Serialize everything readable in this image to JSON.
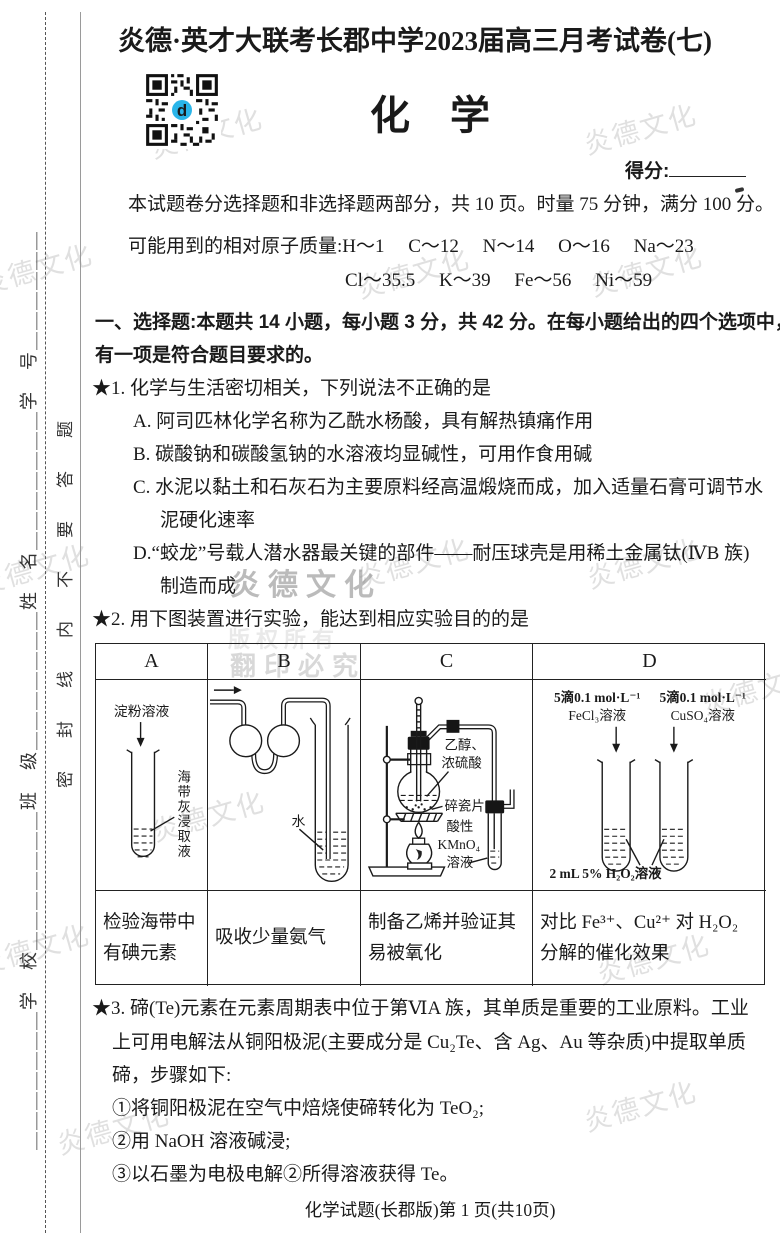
{
  "header": {
    "exam_title": "炎德·英才大联考长郡中学2023届高三月考试卷(七)",
    "subject_title": "化　学",
    "score_label": "得分:"
  },
  "margin": {
    "fields_line": "＿＿＿＿＿＿＿学　校＿＿＿＿＿＿＿班　级＿＿＿＿＿＿＿姓　名＿＿＿＿＿＿＿学　号＿＿＿＿＿＿",
    "seal_notice": "密封线内不要答题"
  },
  "intro": {
    "summary": "本试题卷分选择题和非选择题两部分，共 10 页。时量 75 分钟，满分 100 分。",
    "masses_line1": "可能用到的相对原子质量:H～1　 C～12　 N～14　 O～16　 Na～23",
    "masses_line2": "Cl～35.5　 K～39　 Fe～56　 Ni～59"
  },
  "section_one": {
    "line1": "一、选择题:本题共 14 小题，每小题 3 分，共 42 分。在每小题给出的四个选项中，只",
    "line2": "有一项是符合题目要求的。"
  },
  "q1": {
    "stem": "★1. 化学与生活密切相关，下列说法不正确的是",
    "option_a": "A. 阿司匹林化学名称为乙酰水杨酸，具有解热镇痛作用",
    "option_b": "B. 碳酸钠和碳酸氢钠的水溶液均显碱性，可用作食用碱",
    "option_c1": "C. 水泥以黏土和石灰石为主要原料经高温煅烧而成，加入适量石膏可调节水",
    "option_c2": "泥硬化速率",
    "option_d1": "D.“蛟龙”号载人潜水器最关键的部件——耐压球壳是用稀土金属钛(ⅣB 族)",
    "option_d2": "制造而成"
  },
  "q2": {
    "stem": "★2. 用下图装置进行实验，能达到相应实验目的的是",
    "table": {
      "headers": [
        "A",
        "B",
        "C",
        "D"
      ],
      "captions": {
        "a1": "检验海带中",
        "a2": "有碘元素",
        "b": "吸收少量氨气",
        "c1": "制备乙烯并验证其",
        "c2": "易被氧化",
        "d1": "对比 Fe³⁺、Cu²⁺ 对 H₂O₂",
        "d2": "分解的催化效果"
      }
    },
    "diagrams": {
      "a": {
        "top_label": "淀粉溶液",
        "side_chars": [
          "海",
          "带",
          "灰",
          "浸",
          "取",
          "液"
        ]
      },
      "b": {
        "water": "水"
      },
      "c": {
        "l1a": "乙醇、",
        "l1b": "浓硫酸",
        "l2": "碎瓷片",
        "l3a": "酸性",
        "l3b": "KMnO₄",
        "l3c": "溶液"
      },
      "d": {
        "left1": "5滴0.1 mol·L⁻¹",
        "left2": "FeCl₃溶液",
        "right1": "5滴0.1 mol·L⁻¹",
        "right2": "CuSO₄溶液",
        "bottom": "2 mL 5% H₂O₂溶液"
      }
    }
  },
  "q3": {
    "line1": "★3. 碲(Te)元素在元素周期表中位于第ⅥA 族，其单质是重要的工业原料。工业",
    "line2": "上可用电解法从铜阳极泥(主要成分是 Cu₂Te、含 Ag、Au 等杂质)中提取单质",
    "line3": "碲，步骤如下:",
    "step1": "①将铜阳极泥在空气中焙烧使碲转化为 TeO₂;",
    "step2": "②用 NaOH 溶液碱浸;",
    "step3": "③以石墨为电极电解②所得溶液获得 Te。"
  },
  "footer": {
    "text": "化学试题(长郡版)第 1 页(共10页)"
  },
  "watermarks": {
    "brand": "炎德文化",
    "warning": "翻印必究",
    "copyright": "版权所有"
  },
  "colors": {
    "qr_logo": "#2ab5e9",
    "text": "#1a1a1a"
  }
}
